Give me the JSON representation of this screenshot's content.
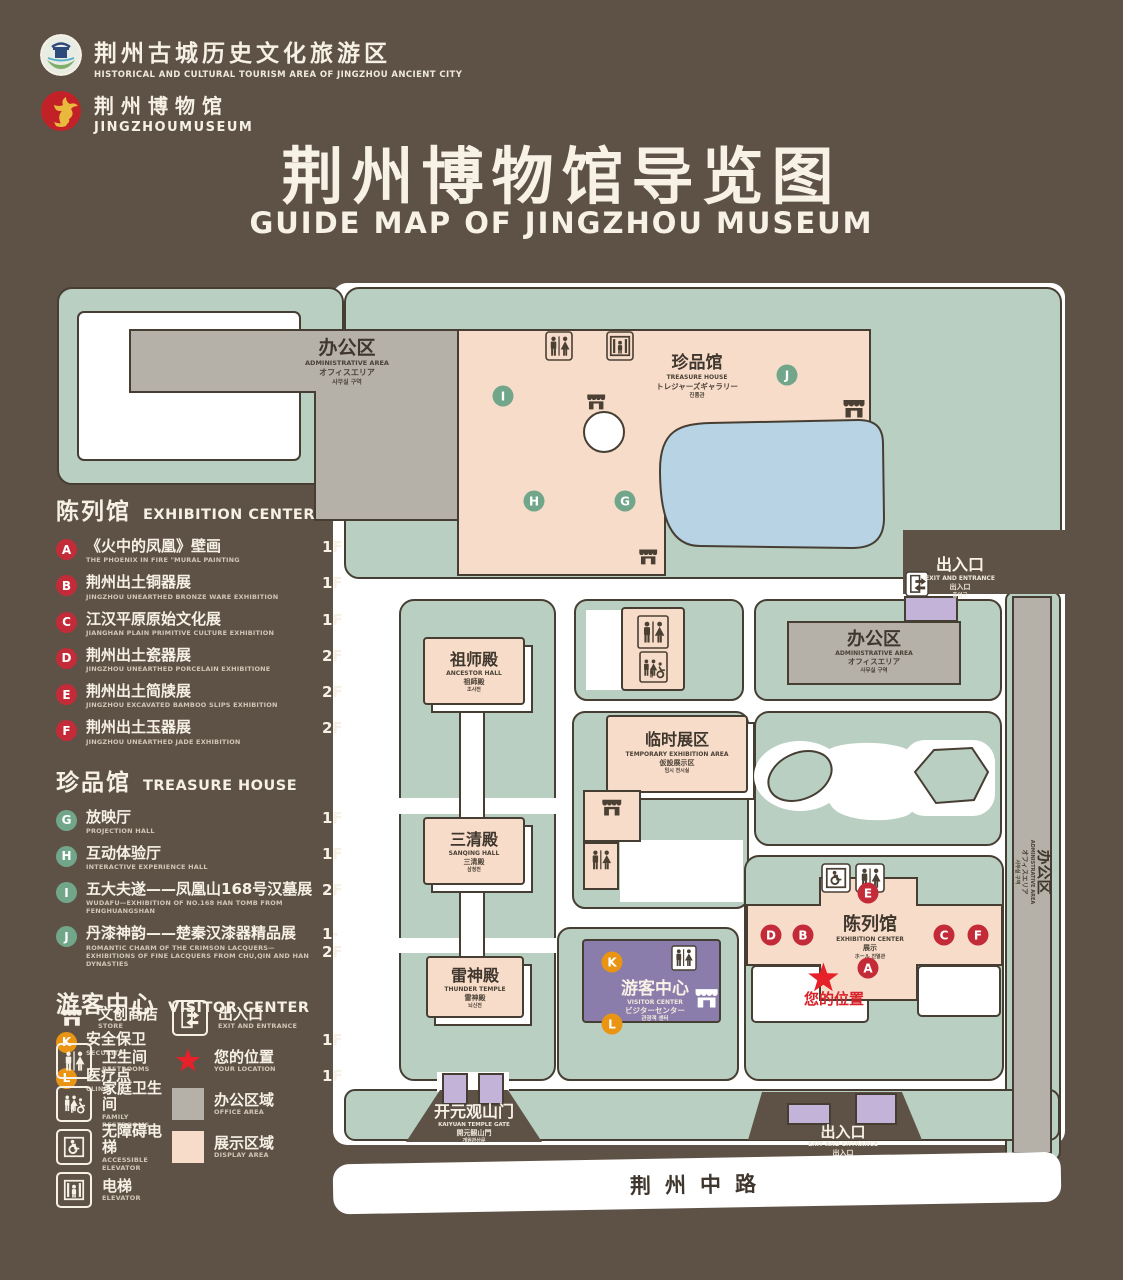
{
  "header": {
    "logo1": {
      "zh": "荆州古城历史文化旅游区",
      "en": "HISTORICAL AND CULTURAL TOURISM AREA OF JINGZHOU ANCIENT CITY"
    },
    "logo2": {
      "zh": "荆州博物馆",
      "en": "JINGZHOUMUSEUM"
    },
    "title": {
      "zh": "荆州博物馆导览图",
      "en": "GUIDE MAP OF JINGZHOU MUSEUM"
    }
  },
  "legend": {
    "sections": [
      {
        "zh": "陈列馆",
        "en": "EXHIBITION CENTER",
        "items": [
          {
            "key": "A",
            "zh": "《火中的凤凰》壁画",
            "en": "THE PHOENIX IN FIRE \"MURAL PAINTING",
            "floor": "1F"
          },
          {
            "key": "B",
            "zh": "荆州出土铜器展",
            "en": "JINGZHOU UNEARTHED BRONZE WARE EXHIBITION",
            "floor": "1F"
          },
          {
            "key": "C",
            "zh": "江汉平原原始文化展",
            "en": "JIANGHAN PLAIN PRIMITIVE CULTURE EXHIBITION",
            "floor": "1F"
          },
          {
            "key": "D",
            "zh": "荆州出土瓷器展",
            "en": "JINGZHOU UNEARTHED PORCELAIN EXHIBITIONE",
            "floor": "2F"
          },
          {
            "key": "E",
            "zh": "荆州出土简牍展",
            "en": "JINGZHOU EXCAVATED BAMBOO SLIPS EXHIBITION",
            "floor": "2F"
          },
          {
            "key": "F",
            "zh": "荆州出土玉器展",
            "en": "JINGZHOU UNEARTHED JADE EXHIBITION",
            "floor": "2F"
          }
        ]
      },
      {
        "zh": "珍品馆",
        "en": "TREASURE HOUSE",
        "items": [
          {
            "key": "G",
            "zh": "放映厅",
            "en": "PROJECTION HALL",
            "floor": "1F"
          },
          {
            "key": "H",
            "zh": "互动体验厅",
            "en": "INTERACTIVE EXPERIENCE HALL",
            "floor": "1F"
          },
          {
            "key": "I",
            "zh": "五大夫遂——凤凰山168号汉墓展",
            "en": "WUDAFU—EXHIBITION OF NO.168 HAN TOMB FROM FENGHUANGSHAN",
            "floor": "2F"
          },
          {
            "key": "J",
            "zh": "丹漆神韵——楚秦汉漆器精品展",
            "en": "ROMANTIC CHARM OF THE CRIMSON LACQUERS—EXHIBITIONS OF FINE LACQUERS FROM CHU,QIN AND HAN DYNASTIES",
            "floor": "1-2F"
          }
        ]
      },
      {
        "zh": "游客中心",
        "en": "VISITOR CENTER",
        "items": [
          {
            "key": "K",
            "zh": "安全保卫",
            "en": "SECURITY",
            "floor": "1F"
          },
          {
            "key": "L",
            "zh": "医疗点",
            "en": "CLINIC",
            "floor": "1F"
          }
        ]
      }
    ],
    "icons": [
      {
        "zh": "文创商店",
        "en": "STORE"
      },
      {
        "zh": "出入口",
        "en": "EXIT AND ENTRANCE"
      },
      {
        "zh": "卫生间",
        "en": "RESTROOMS"
      },
      {
        "zh": "您的位置",
        "en": "YOUR LOCATION"
      },
      {
        "zh": "家庭卫生间",
        "en": "FAMILY RESTROOMS"
      },
      {
        "zh": "办公区域",
        "en": "OFFICE AREA"
      },
      {
        "zh": "无障碍电梯",
        "en": "ACCESSIBLE ELEVATOR"
      },
      {
        "zh": "展示区域",
        "en": "DISPLAY AREA"
      },
      {
        "zh": "电梯",
        "en": "ELEVATOR"
      }
    ]
  },
  "map": {
    "buildings": {
      "admin_top": {
        "zh": "办公区",
        "en": "ADMINISTRATIVE AREA",
        "ja": "オフィスエリア",
        "ko": "사무실 구역"
      },
      "treasure": {
        "zh": "珍品馆",
        "en": "TREASURE HOUSE",
        "ja": "トレジャーズギャラリー",
        "ko": "진품관"
      },
      "ancestor": {
        "zh": "祖师殿",
        "en": "ANCESTOR HALL",
        "ja": "祖師殿",
        "ko": "조사전"
      },
      "temporary": {
        "zh": "临时展区",
        "en": "TEMPORARY EXHIBITION AREA",
        "ja": "仮設展示区",
        "ko": "임시 전시실"
      },
      "sanqing": {
        "zh": "三清殿",
        "en": "SANQING HALL",
        "ja": "三清殿",
        "ko": "삼청전"
      },
      "thunder": {
        "zh": "雷神殿",
        "en": "THUNDER TEMPLE",
        "ja": "雷神殿",
        "ko": "뇌신전"
      },
      "visitor": {
        "zh": "游客中心",
        "en": "VISITOR CENTER",
        "ja": "ビジターセンター",
        "ko": "관광객 센터"
      },
      "admin_right": {
        "zh": "办公区",
        "en": "ADMINISTRATIVE AREA",
        "ja": "オフィスエリア",
        "ko": "사무실 구역"
      },
      "admin_east": {
        "zh": "办公区",
        "en": "ADMINISTRATIVE AREA",
        "ja": "オフィスエリア",
        "ko": "사무실 구역"
      },
      "exhibition": {
        "zh": "陈列馆",
        "en": "EXHIBITION CENTER",
        "ja": "展示",
        "ko": "ホール 진열관"
      },
      "gate": {
        "zh": "开元观山门",
        "en": "KAIYUAN TEMPLE GATE",
        "ja": "開元観山門",
        "ko": "개원관산문"
      }
    },
    "exits": {
      "top": {
        "zh": "出入口",
        "en": "EXIT AND ENTRANCE",
        "ja": "出入口",
        "ko": "출입구"
      },
      "bottom": {
        "zh": "出入口",
        "en": "EXIT AND ENTRANCE",
        "ja": "出入口",
        "ko": "출입구"
      }
    },
    "markers": [
      "A",
      "B",
      "C",
      "D",
      "E",
      "F",
      "G",
      "H",
      "I",
      "J",
      "K",
      "L"
    ],
    "your_location": "您的位置",
    "road": "荆州中路"
  }
}
